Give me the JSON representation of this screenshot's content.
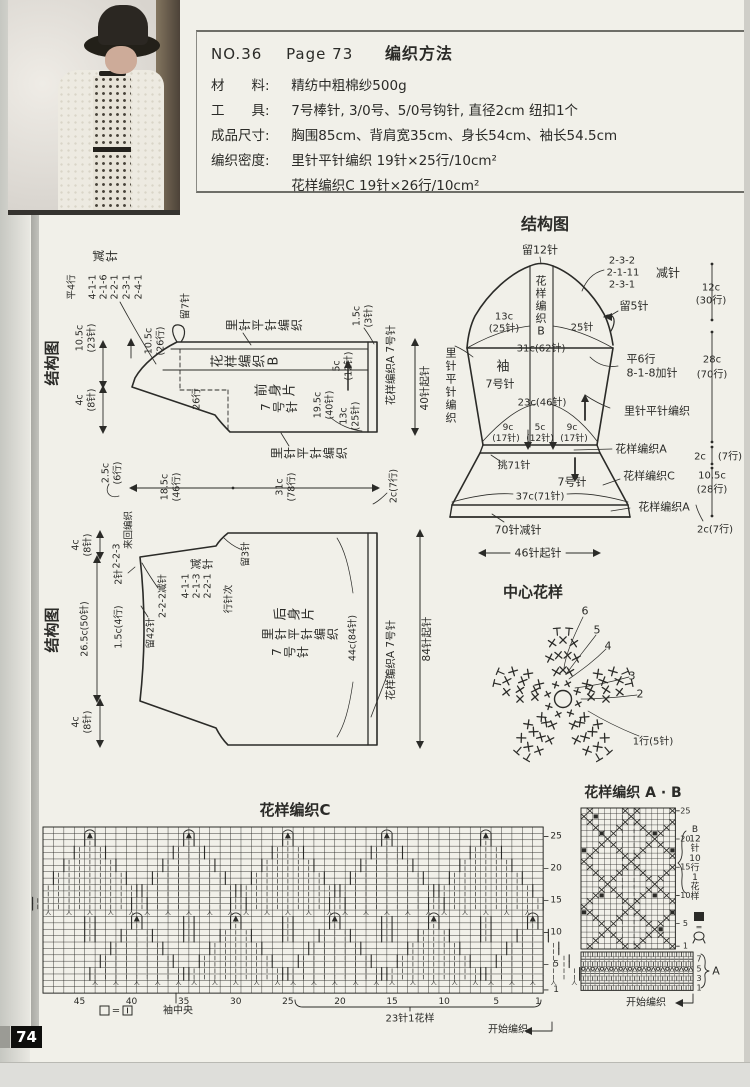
{
  "page": {
    "number": "74"
  },
  "colors": {
    "ink": "#2b2b28",
    "paper": "#f1f0e9",
    "grid": "#6f6f69"
  },
  "header": {
    "issue_no": "NO.36",
    "page_ref": "Page 73",
    "title": "编织方法",
    "lines": [
      {
        "label": "材　　料:",
        "text": "精纺中粗棉纱500g"
      },
      {
        "label": "工　　具:",
        "text": "7号棒针, 3/0号、5/0号钩针, 直径2cm 纽扣1个"
      },
      {
        "label": "成品尺寸:",
        "text": "胸围85cm、背肩宽35cm、身长54cm、袖长54.5cm"
      },
      {
        "label": "编织密度:",
        "text": "里针平针编织 19针×25行/10cm²"
      },
      {
        "label": "编织密度:",
        "text": "花样编织C 19针×26行/10cm²"
      }
    ]
  },
  "photo": {
    "caption": "model wearing knitted lace cardigan over floral dress with dark hat"
  },
  "front_piece": {
    "title": "结构图",
    "labels": [
      {
        "m": "rs",
        "t": "结构图",
        "x": 52,
        "y": 363,
        "s": 15,
        "b": 1,
        "n": "front-schematic-title"
      },
      {
        "m": "rc",
        "t": "减针",
        "x": 99,
        "y": 256,
        "s": 12,
        "st": 13
      },
      {
        "m": "rs",
        "t": "平4行",
        "x": 72,
        "y": 287,
        "s": 9.5
      },
      {
        "m": "rs",
        "t": "4-1-1",
        "x": 93,
        "y": 287,
        "s": 9.5
      },
      {
        "m": "rs",
        "t": "2-1-6",
        "x": 104,
        "y": 287,
        "s": 9.5
      },
      {
        "m": "rs",
        "t": "2-2-1",
        "x": 115,
        "y": 287,
        "s": 9.5
      },
      {
        "m": "rs",
        "t": "2-3-1",
        "x": 127,
        "y": 287,
        "s": 9.5
      },
      {
        "m": "rs",
        "t": "2-4-1",
        "x": 139,
        "y": 287,
        "s": 9.5
      },
      {
        "m": "rs",
        "t": "留7针",
        "x": 186,
        "y": 306,
        "s": 10
      },
      {
        "m": "rs",
        "t": "10.5c",
        "x": 149,
        "y": 341,
        "s": 9.5
      },
      {
        "m": "rs",
        "t": "(26行)",
        "x": 161,
        "y": 341,
        "s": 9.5
      },
      {
        "m": "rs",
        "t": "10.5c",
        "x": 80,
        "y": 338,
        "s": 9.5
      },
      {
        "m": "rs",
        "t": "(23针)",
        "x": 92,
        "y": 338,
        "s": 9.5
      },
      {
        "m": "rs",
        "t": "4c",
        "x": 80,
        "y": 400,
        "s": 9.5
      },
      {
        "m": "rs",
        "t": "(8针)",
        "x": 92,
        "y": 400,
        "s": 9.5
      },
      {
        "m": "rc",
        "t": "里针平针编织",
        "x": 232,
        "y": 325,
        "s": 12,
        "st": 13
      },
      {
        "m": "rc",
        "t": "花样编织B",
        "x": 218,
        "y": 361,
        "s": 13,
        "st": 14
      },
      {
        "m": "rs",
        "t": "26行",
        "x": 197,
        "y": 399,
        "s": 9.5
      },
      {
        "m": "rc",
        "t": "前身片",
        "x": 262,
        "y": 390,
        "s": 13,
        "st": 14
      },
      {
        "m": "rc",
        "t": "7号针",
        "x": 266,
        "y": 407,
        "s": 12,
        "st": 13
      },
      {
        "m": "rc",
        "t": "里针平针编织",
        "x": 277,
        "y": 453,
        "s": 12,
        "st": 13
      },
      {
        "m": "rs",
        "t": "19.5c",
        "x": 318,
        "y": 405,
        "s": 9.5
      },
      {
        "m": "rs",
        "t": "(40针)",
        "x": 330,
        "y": 405,
        "s": 9.5
      },
      {
        "m": "rs",
        "t": "13c",
        "x": 344,
        "y": 416,
        "s": 9.5
      },
      {
        "m": "rs",
        "t": "(25针)",
        "x": 356,
        "y": 416,
        "s": 9.5
      },
      {
        "m": "rs",
        "t": "5c",
        "x": 337,
        "y": 366,
        "s": 9.5
      },
      {
        "m": "rs",
        "t": "(12针)",
        "x": 349,
        "y": 366,
        "s": 9.5
      },
      {
        "m": "rs",
        "t": "1.5c",
        "x": 357,
        "y": 316,
        "s": 9.5
      },
      {
        "m": "rs",
        "t": "(3针)",
        "x": 369,
        "y": 316,
        "s": 9.5
      },
      {
        "m": "rs",
        "t": "花样编织A 7号针",
        "x": 391,
        "y": 365,
        "s": 10.5
      },
      {
        "m": "rs",
        "t": "40针起针",
        "x": 425,
        "y": 388,
        "s": 10.5
      },
      {
        "m": "rs",
        "t": "2.5c",
        "x": 106,
        "y": 473,
        "s": 9.5
      },
      {
        "m": "rs",
        "t": "(6行)",
        "x": 118,
        "y": 473,
        "s": 9.5
      },
      {
        "m": "rs",
        "t": "18.5c",
        "x": 165,
        "y": 487,
        "s": 9.5
      },
      {
        "m": "rs",
        "t": "(46行)",
        "x": 177,
        "y": 487,
        "s": 9.5
      },
      {
        "m": "rs",
        "t": "31c",
        "x": 280,
        "y": 487,
        "s": 9.5
      },
      {
        "m": "rs",
        "t": "(78行)",
        "x": 292,
        "y": 487,
        "s": 9.5
      },
      {
        "m": "rs",
        "t": "2c(7行)",
        "x": 394,
        "y": 486,
        "s": 9.5
      }
    ]
  },
  "back_piece": {
    "title": "结构图",
    "labels": [
      {
        "m": "rs",
        "t": "结构图",
        "x": 52,
        "y": 630,
        "s": 15,
        "b": 1,
        "n": "back-schematic-title"
      },
      {
        "m": "rs",
        "t": "来回编织",
        "x": 129,
        "y": 530,
        "s": 9.5
      },
      {
        "m": "rs",
        "t": "2-2-3",
        "x": 117,
        "y": 556,
        "s": 9.5
      },
      {
        "m": "rs",
        "t": "2针",
        "x": 119,
        "y": 577,
        "s": 9.5
      },
      {
        "m": "rs",
        "t": "2-2-2减针",
        "x": 163,
        "y": 596,
        "s": 9.5
      },
      {
        "m": "rs",
        "t": "4-1-1",
        "x": 186,
        "y": 586,
        "s": 9.5
      },
      {
        "m": "rs",
        "t": "2-1-3",
        "x": 197,
        "y": 586,
        "s": 9.5
      },
      {
        "m": "rs",
        "t": "2-2-1",
        "x": 208,
        "y": 586,
        "s": 9.5
      },
      {
        "m": "rs",
        "t": "行针次",
        "x": 229,
        "y": 599,
        "s": 9.5
      },
      {
        "m": "rc",
        "t": "减针",
        "x": 196,
        "y": 564,
        "s": 11,
        "st": 12
      },
      {
        "m": "rs",
        "t": "留3针",
        "x": 246,
        "y": 554,
        "s": 9.5
      },
      {
        "m": "rs",
        "t": "留42针",
        "x": 151,
        "y": 633,
        "s": 9.5
      },
      {
        "m": "rs",
        "t": "1.5c(4行)",
        "x": 119,
        "y": 627,
        "s": 9.5
      },
      {
        "m": "rs",
        "t": "26.5c(50针)",
        "x": 85,
        "y": 629,
        "s": 9.5
      },
      {
        "m": "rs",
        "t": "4c",
        "x": 76,
        "y": 545,
        "s": 9.5
      },
      {
        "m": "rs",
        "t": "(8针)",
        "x": 88,
        "y": 545,
        "s": 9.5
      },
      {
        "m": "rs",
        "t": "4c",
        "x": 76,
        "y": 722,
        "s": 9.5
      },
      {
        "m": "rs",
        "t": "(8针)",
        "x": 88,
        "y": 722,
        "s": 9.5
      },
      {
        "m": "rc",
        "t": "后身片",
        "x": 281,
        "y": 614,
        "s": 13,
        "st": 14
      },
      {
        "m": "rc",
        "t": "里针平针编织",
        "x": 268,
        "y": 634,
        "s": 12,
        "st": 13
      },
      {
        "m": "rc",
        "t": "7号针",
        "x": 277,
        "y": 652,
        "s": 12,
        "st": 13
      },
      {
        "m": "rs",
        "t": "44c(84针)",
        "x": 353,
        "y": 638,
        "s": 9.5
      },
      {
        "m": "rs",
        "t": "花样编织A 7号针",
        "x": 391,
        "y": 660,
        "s": 10.5
      },
      {
        "m": "rs",
        "t": "84针起针",
        "x": 427,
        "y": 639,
        "s": 10.5
      }
    ]
  },
  "sleeve": {
    "title": "结构图",
    "labels": [
      {
        "m": "h",
        "t": "结构图",
        "x": 545,
        "y": 224,
        "s": 16,
        "b": 1,
        "n": "sleeve-schematic-title"
      },
      {
        "m": "h",
        "t": "留12针",
        "x": 540,
        "y": 250,
        "s": 11
      },
      {
        "m": "h",
        "t": "2-3-2",
        "x": 622,
        "y": 261,
        "s": 10
      },
      {
        "m": "h",
        "t": "2-1-11",
        "x": 623,
        "y": 273,
        "s": 10
      },
      {
        "m": "h",
        "t": "2-3-1",
        "x": 622,
        "y": 285,
        "s": 10
      },
      {
        "m": "h",
        "t": "减针",
        "x": 668,
        "y": 273,
        "s": 12
      },
      {
        "m": "h",
        "t": "留5针",
        "x": 634,
        "y": 306,
        "s": 11
      },
      {
        "m": "h",
        "t": "13c",
        "x": 504,
        "y": 317,
        "s": 10
      },
      {
        "m": "h",
        "t": "(25针)",
        "x": 504,
        "y": 329,
        "s": 10
      },
      {
        "m": "h",
        "t": "25针",
        "x": 582,
        "y": 328,
        "s": 10
      },
      {
        "m": "h",
        "t": "31c(62针)",
        "x": 541,
        "y": 349,
        "s": 10
      },
      {
        "m": "v",
        "t": "花样编织B",
        "x": 541,
        "y": 281,
        "s": 11,
        "st": 12.5
      },
      {
        "m": "v",
        "t": "里针平针编织",
        "x": 451,
        "y": 353,
        "s": 11,
        "st": 13
      },
      {
        "m": "h",
        "t": "袖",
        "x": 503,
        "y": 367,
        "s": 13
      },
      {
        "m": "h",
        "t": "7号针",
        "x": 500,
        "y": 384,
        "s": 11
      },
      {
        "m": "h",
        "t": "平6行",
        "x": 641,
        "y": 359,
        "s": 11
      },
      {
        "m": "h",
        "t": "8-1-8加针",
        "x": 652,
        "y": 373,
        "s": 11
      },
      {
        "m": "h",
        "t": "23c(46针)",
        "x": 542,
        "y": 403,
        "s": 10
      },
      {
        "m": "h",
        "t": "里针平针编织",
        "x": 657,
        "y": 411,
        "s": 11
      },
      {
        "m": "h",
        "t": "9c",
        "x": 508,
        "y": 428,
        "s": 9
      },
      {
        "m": "h",
        "t": "(17针)",
        "x": 506,
        "y": 439,
        "s": 9
      },
      {
        "m": "h",
        "t": "5c",
        "x": 540,
        "y": 428,
        "s": 9
      },
      {
        "m": "h",
        "t": "(12针)",
        "x": 540,
        "y": 439,
        "s": 9
      },
      {
        "m": "h",
        "t": "9c",
        "x": 572,
        "y": 428,
        "s": 9
      },
      {
        "m": "h",
        "t": "(17针)",
        "x": 574,
        "y": 439,
        "s": 9
      },
      {
        "m": "h",
        "t": "花样编织A",
        "x": 641,
        "y": 449,
        "s": 11
      },
      {
        "m": "h",
        "t": "挑71针",
        "x": 514,
        "y": 466,
        "s": 10
      },
      {
        "m": "h",
        "t": "7号针",
        "x": 572,
        "y": 482,
        "s": 11
      },
      {
        "m": "h",
        "t": "花样编织C",
        "x": 649,
        "y": 476,
        "s": 11
      },
      {
        "m": "h",
        "t": "37c(71针)",
        "x": 540,
        "y": 497,
        "s": 10
      },
      {
        "m": "h",
        "t": "花样编织A",
        "x": 664,
        "y": 507,
        "s": 11
      },
      {
        "m": "h",
        "t": "70针减针",
        "x": 518,
        "y": 530,
        "s": 11
      },
      {
        "m": "h",
        "t": "46针起针",
        "x": 538,
        "y": 553,
        "s": 11
      },
      {
        "m": "h",
        "t": "12c",
        "x": 711,
        "y": 288,
        "s": 10
      },
      {
        "m": "h",
        "t": "(30行)",
        "x": 711,
        "y": 301,
        "s": 10
      },
      {
        "m": "h",
        "t": "28c",
        "x": 712,
        "y": 360,
        "s": 10
      },
      {
        "m": "h",
        "t": "(70行)",
        "x": 712,
        "y": 375,
        "s": 10
      },
      {
        "m": "h",
        "t": "2c",
        "x": 700,
        "y": 457,
        "s": 10
      },
      {
        "m": "h",
        "t": "(7行)",
        "x": 730,
        "y": 457,
        "s": 10
      },
      {
        "m": "h",
        "t": "10.5c",
        "x": 712,
        "y": 476,
        "s": 10
      },
      {
        "m": "h",
        "t": "(28行)",
        "x": 712,
        "y": 490,
        "s": 10
      },
      {
        "m": "h",
        "t": "2c(7行)",
        "x": 715,
        "y": 530,
        "s": 10
      }
    ]
  },
  "center_motif": {
    "title": "中心花样",
    "round_numbers": [
      "6",
      "5",
      "4",
      "3",
      "2"
    ],
    "round1_label": "1行(5针)"
  },
  "chart_c": {
    "title": "花样编织C",
    "x": 43,
    "y": 827,
    "cols": 48,
    "rows": 26,
    "cw": 10.42,
    "chh": 6.39,
    "right_numbers": [
      25,
      20,
      15,
      10,
      5,
      1
    ],
    "bottom_numbers": [
      45,
      40,
      35,
      30,
      25,
      20,
      15,
      10,
      5,
      1
    ],
    "legend": "□ = ⊡",
    "center_label": "袖中央",
    "repeat_label": "23针1花样",
    "start_label": "开始编织"
  },
  "chart_ab": {
    "title": "花样编织 A · B",
    "b": {
      "x": 581,
      "y": 808,
      "cols": 16,
      "rows": 25,
      "cw": 5.9,
      "chh": 5.64,
      "right_numbers": [
        25,
        20,
        15,
        10,
        5,
        1
      ],
      "side_label": [
        "B",
        "12",
        "针",
        "10",
        "行",
        "1",
        "花",
        "样"
      ],
      "black_squares": [
        [
          3,
          21
        ],
        [
          12,
          21
        ],
        [
          0,
          18
        ],
        [
          15,
          18
        ],
        [
          3,
          10
        ],
        [
          12,
          10
        ],
        [
          0,
          7
        ],
        [
          15,
          7
        ],
        [
          13,
          4
        ],
        [
          2,
          24
        ]
      ]
    },
    "legend": {
      "square": "■",
      "equals": "=",
      "meaning": "bobble"
    },
    "a": {
      "x": 581,
      "y": 952,
      "cols": 24,
      "rows": 8,
      "cw": 4.67,
      "chh": 4.8,
      "right_numbers": [
        7,
        5,
        3,
        1
      ],
      "side_label": "A"
    },
    "start_label": "开始编织"
  }
}
